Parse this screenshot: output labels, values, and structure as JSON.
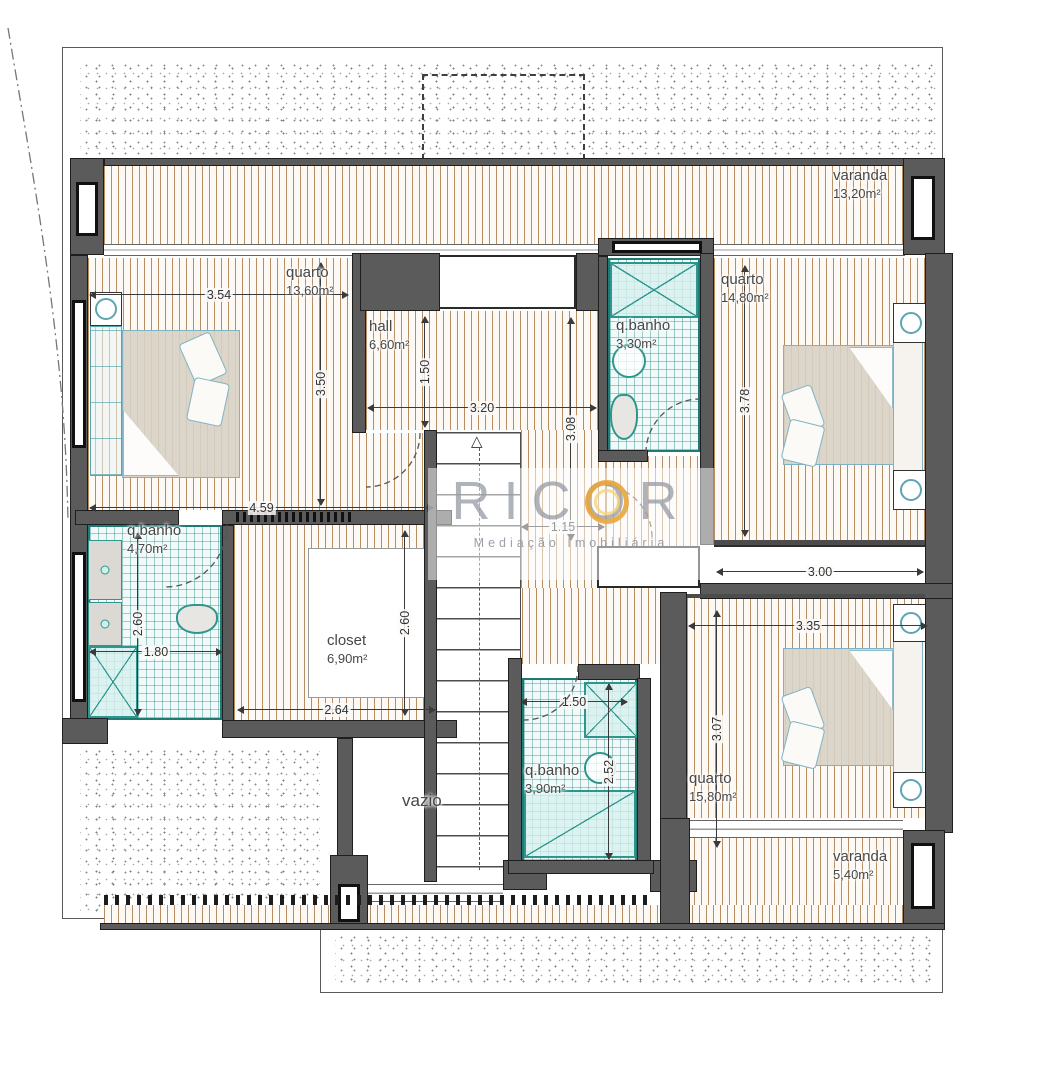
{
  "watermark": {
    "brand": "RICOR",
    "tagline": "Mediação Imobiliária",
    "accent": "#E8A33B",
    "text_color": "#9499A3"
  },
  "colors": {
    "wall": "#5B5B5B",
    "deck_stripe": "#AB7A4A",
    "tile_line": "#2F968E",
    "tile_border": "#1E7B74",
    "bed_outline": "#7FB3C4",
    "dim_text": "#333333",
    "label_text": "#474747"
  },
  "outlines": [
    [
      62,
      47,
      881,
      872
    ],
    [
      320,
      925,
      623,
      68
    ]
  ],
  "stipples": [
    [
      80,
      60,
      858,
      100
    ],
    [
      80,
      746,
      240,
      166
    ],
    [
      335,
      932,
      600,
      54
    ]
  ],
  "dashed_rects": [
    [
      422,
      74,
      163,
      86
    ]
  ],
  "floors_deck": [
    [
      104,
      166,
      799,
      78
    ],
    [
      88,
      258,
      264,
      252
    ],
    [
      366,
      311,
      236,
      119
    ],
    [
      352,
      433,
      72,
      77
    ],
    [
      521,
      430,
      86,
      158
    ],
    [
      606,
      456,
      94,
      90
    ],
    [
      522,
      588,
      138,
      76
    ],
    [
      714,
      258,
      211,
      282
    ],
    [
      234,
      525,
      206,
      195
    ],
    [
      687,
      597,
      238,
      221
    ],
    [
      687,
      838,
      216,
      85
    ],
    [
      104,
      905,
      801,
      20
    ]
  ],
  "floors_tile": [
    [
      608,
      258,
      92,
      194
    ],
    [
      88,
      525,
      134,
      195
    ],
    [
      522,
      678,
      115,
      184
    ]
  ],
  "white_frames": [
    [
      308,
      548,
      132,
      150
    ]
  ],
  "bands_glaze": [
    [
      104,
      244,
      801,
      12
    ],
    [
      690,
      820,
      213,
      18
    ],
    [
      365,
      884,
      138,
      18
    ]
  ],
  "bands_plain": [
    [
      714,
      545,
      211,
      38
    ]
  ],
  "niches": [
    [
      438,
      255,
      138,
      54
    ],
    [
      597,
      546,
      103,
      42
    ]
  ],
  "combs": [
    [
      236,
      512,
      118,
      10
    ]
  ],
  "railings": [
    [
      104,
      895,
      550,
      10
    ]
  ],
  "stairs": {
    "rect": [
      437,
      432,
      84,
      446
    ],
    "arrow_glyph": "△"
  },
  "walls": [
    [
      70,
      158,
      34,
      97
    ],
    [
      104,
      158,
      801,
      8
    ],
    [
      903,
      158,
      42,
      97
    ],
    [
      70,
      255,
      18,
      470
    ],
    [
      62,
      718,
      46,
      26
    ],
    [
      352,
      253,
      14,
      180
    ],
    [
      360,
      253,
      80,
      58
    ],
    [
      576,
      253,
      26,
      58
    ],
    [
      598,
      238,
      116,
      18
    ],
    [
      598,
      256,
      10,
      200
    ],
    [
      700,
      253,
      14,
      292
    ],
    [
      598,
      450,
      50,
      12
    ],
    [
      925,
      253,
      28,
      580
    ],
    [
      700,
      583,
      253,
      16
    ],
    [
      75,
      510,
      104,
      15
    ],
    [
      222,
      510,
      230,
      15
    ],
    [
      222,
      525,
      12,
      198
    ],
    [
      222,
      720,
      235,
      18
    ],
    [
      337,
      738,
      16,
      190
    ],
    [
      424,
      430,
      13,
      452
    ],
    [
      330,
      855,
      38,
      72
    ],
    [
      503,
      860,
      44,
      30
    ],
    [
      650,
      860,
      47,
      32
    ],
    [
      508,
      658,
      14,
      212
    ],
    [
      578,
      664,
      62,
      16
    ],
    [
      637,
      678,
      14,
      192
    ],
    [
      508,
      860,
      146,
      14
    ],
    [
      660,
      592,
      27,
      270
    ],
    [
      660,
      818,
      30,
      110
    ],
    [
      903,
      830,
      42,
      98
    ],
    [
      100,
      923,
      845,
      7
    ]
  ],
  "wall_thins": [
    [
      714,
      540,
      211,
      5
    ],
    [
      687,
      594,
      238,
      4
    ]
  ],
  "windows": [
    [
      76,
      182,
      22,
      54
    ],
    [
      911,
      176,
      24,
      64
    ],
    [
      612,
      241,
      90,
      12
    ],
    [
      72,
      300,
      14,
      148
    ],
    [
      72,
      552,
      14,
      150
    ],
    [
      338,
      884,
      22,
      38
    ],
    [
      911,
      843,
      24,
      66
    ]
  ],
  "furniture": [
    {
      "c": "wardrobe",
      "r": [
        90,
        326,
        32,
        150
      ]
    },
    {
      "c": "nightstand",
      "r": [
        90,
        292,
        32,
        34
      ]
    },
    {
      "c": "bed",
      "r": [
        122,
        330,
        118,
        148
      ]
    },
    {
      "c": "pillow",
      "r": [
        186,
        336,
        34,
        46
      ],
      "rot": -24
    },
    {
      "c": "pillow",
      "r": [
        190,
        380,
        36,
        44
      ],
      "rot": 12
    },
    {
      "c": "fold",
      "r": [
        123,
        410,
        56,
        66
      ],
      "clip": "polygon(0 0,0 100%,100% 100%)"
    },
    {
      "c": "bed",
      "r": [
        783,
        345,
        112,
        120
      ]
    },
    {
      "c": "fold",
      "r": [
        849,
        347,
        44,
        62
      ],
      "clip": "polygon(0 0,100% 0,100% 100%)"
    },
    {
      "c": "headboard",
      "r": [
        893,
        336,
        30,
        136
      ]
    },
    {
      "c": "nightstand",
      "r": [
        893,
        303,
        36,
        40
      ]
    },
    {
      "c": "nightstand",
      "r": [
        893,
        470,
        36,
        40
      ]
    },
    {
      "c": "pillow",
      "r": [
        787,
        388,
        32,
        44
      ],
      "rot": -20
    },
    {
      "c": "pillow",
      "r": [
        785,
        422,
        36,
        42
      ],
      "rot": 14
    },
    {
      "c": "bed",
      "r": [
        783,
        648,
        112,
        118
      ]
    },
    {
      "c": "fold",
      "r": [
        849,
        650,
        44,
        60
      ],
      "clip": "polygon(0 0,100% 0,100% 100%)"
    },
    {
      "c": "headboard",
      "r": [
        893,
        640,
        30,
        134
      ]
    },
    {
      "c": "nightstand",
      "r": [
        893,
        604,
        36,
        38
      ]
    },
    {
      "c": "nightstand",
      "r": [
        893,
        772,
        36,
        36
      ]
    },
    {
      "c": "pillow",
      "r": [
        787,
        690,
        32,
        44
      ],
      "rot": -20
    },
    {
      "c": "pillow",
      "r": [
        785,
        724,
        36,
        42
      ],
      "rot": 14
    },
    {
      "c": "shower",
      "r": [
        610,
        262,
        88,
        56
      ]
    },
    {
      "c": "sink-round",
      "r": [
        612,
        344,
        34,
        34
      ]
    },
    {
      "c": "toilet",
      "r": [
        610,
        394,
        28,
        46
      ]
    },
    {
      "c": "vanity",
      "r": [
        88,
        540,
        34,
        60
      ]
    },
    {
      "c": "vanity",
      "r": [
        88,
        602,
        34,
        44
      ]
    },
    {
      "c": "shower",
      "r": [
        88,
        646,
        50,
        72
      ]
    },
    {
      "c": "toilet",
      "r": [
        176,
        604,
        42,
        30
      ]
    },
    {
      "c": "shower",
      "r": [
        584,
        682,
        54,
        56
      ]
    },
    {
      "c": "sink-round",
      "r": [
        584,
        752,
        32,
        32
      ]
    },
    {
      "c": "tub",
      "r": [
        524,
        790,
        112,
        68
      ]
    }
  ],
  "dimensions": [
    {
      "v": "3.54",
      "o": "h",
      "x": 90,
      "y": 294,
      "len": 258
    },
    {
      "v": "3.50",
      "o": "v",
      "x": 320,
      "y": 263,
      "len": 242
    },
    {
      "v": "1.50",
      "o": "v",
      "x": 424,
      "y": 317,
      "len": 110
    },
    {
      "v": "3.20",
      "o": "h",
      "x": 368,
      "y": 407,
      "len": 228
    },
    {
      "v": "3.08",
      "o": "v",
      "x": 570,
      "y": 318,
      "len": 222
    },
    {
      "v": "3.78",
      "o": "v",
      "x": 744,
      "y": 266,
      "len": 270
    },
    {
      "v": "4.59",
      "o": "h",
      "x": 90,
      "y": 507,
      "len": 343
    },
    {
      "v": "1.15",
      "o": "h",
      "x": 522,
      "y": 526,
      "len": 82
    },
    {
      "v": "2.60",
      "o": "v",
      "x": 137,
      "y": 533,
      "len": 182
    },
    {
      "v": "1.80",
      "o": "h",
      "x": 90,
      "y": 651,
      "len": 132
    },
    {
      "v": "2.60",
      "o": "v",
      "x": 404,
      "y": 531,
      "len": 184
    },
    {
      "v": "2.64",
      "o": "h",
      "x": 238,
      "y": 709,
      "len": 197
    },
    {
      "v": "3.00",
      "o": "h",
      "x": 717,
      "y": 571,
      "len": 206
    },
    {
      "v": "3.35",
      "o": "h",
      "x": 689,
      "y": 625,
      "len": 238
    },
    {
      "v": "3.07",
      "o": "v",
      "x": 716,
      "y": 611,
      "len": 236
    },
    {
      "v": "1.50",
      "o": "h",
      "x": 521,
      "y": 701,
      "len": 106
    },
    {
      "v": "2.52",
      "o": "v",
      "x": 608,
      "y": 684,
      "len": 175
    }
  ],
  "room_labels": [
    {
      "lines": [
        "varanda",
        "13,20m²"
      ],
      "x": 833,
      "y": 167
    },
    {
      "lines": [
        "quarto",
        "13,60m²"
      ],
      "x": 286,
      "y": 264
    },
    {
      "lines": [
        "hall",
        "6,60m²"
      ],
      "x": 369,
      "y": 318
    },
    {
      "lines": [
        "q.banho",
        "3,30m²"
      ],
      "x": 616,
      "y": 317
    },
    {
      "lines": [
        "quarto",
        "14,80m²"
      ],
      "x": 721,
      "y": 271
    },
    {
      "lines": [
        "q.banho",
        "4,70m²"
      ],
      "x": 127,
      "y": 522
    },
    {
      "lines": [
        "closet",
        "6,90m²"
      ],
      "x": 327,
      "y": 632
    },
    {
      "lines": [
        "vazio"
      ],
      "x": 402,
      "y": 790,
      "size": 17
    },
    {
      "lines": [
        "q.banho",
        "3,90m²"
      ],
      "x": 525,
      "y": 762
    },
    {
      "lines": [
        "quarto",
        "15,80m²"
      ],
      "x": 689,
      "y": 770
    },
    {
      "lines": [
        "varanda",
        "5,40m²"
      ],
      "x": 833,
      "y": 848
    }
  ],
  "doors": [
    {
      "p": "M 420 433 A 54 54 0 0 1 366 487"
    },
    {
      "p": "M 646 453 A 54 54 0 0 1 700 399"
    },
    {
      "p": "M 652 537 A 52 52 0 0 0 600 485"
    },
    {
      "p": "M 227 525 A 62 62 0 0 1 165 587"
    },
    {
      "p": "M 578 666 A 54 54 0 0 1 524 720"
    }
  ],
  "property_line": "M 8 28 C 25 130 50 260 62 400 C 66 450 67 480 68 520"
}
